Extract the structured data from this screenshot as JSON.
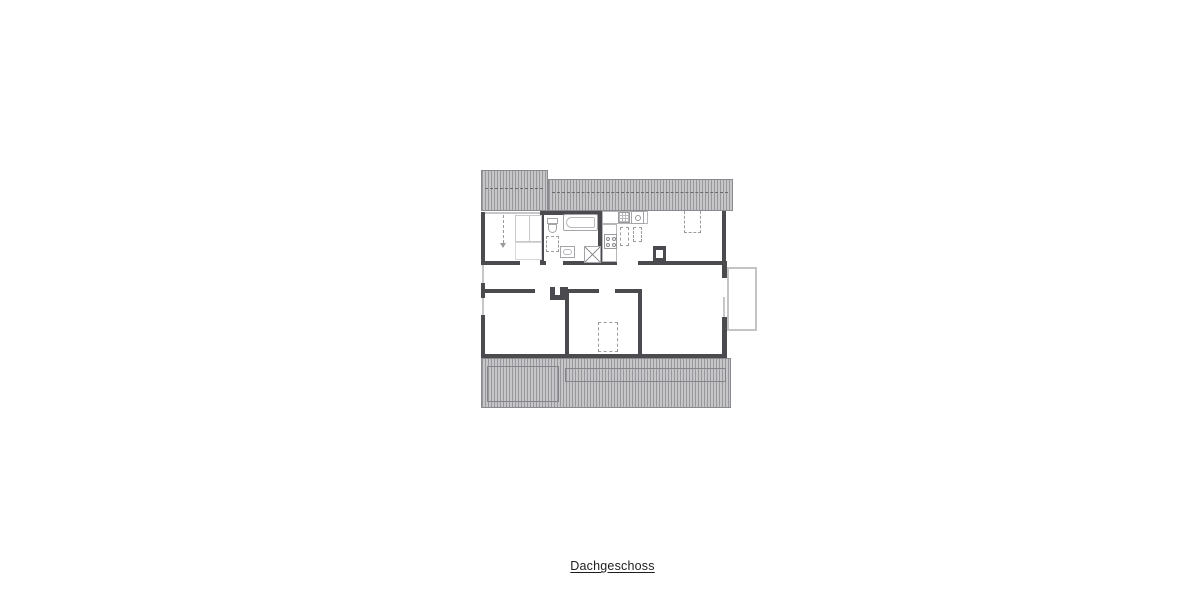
{
  "floorplan": {
    "label": "Dachgeschoss",
    "colors": {
      "wall": "#4b4b4f",
      "roof_hatch_dark": "#98989c",
      "roof_hatch_light": "#c6c6c8",
      "window": "#c7c7c9",
      "fixture_outline": "#a5a5a9",
      "balcony_outline": "#c4c4c6",
      "text": "#1e1e1e"
    },
    "fixtures": [
      "bathtub",
      "shower",
      "wc",
      "washbasin",
      "kitchen-sink",
      "kitchen-stove",
      "kitchen-counter",
      "wardrobe",
      "bed",
      "chimney-living",
      "chimney-corridor",
      "balcony"
    ]
  }
}
